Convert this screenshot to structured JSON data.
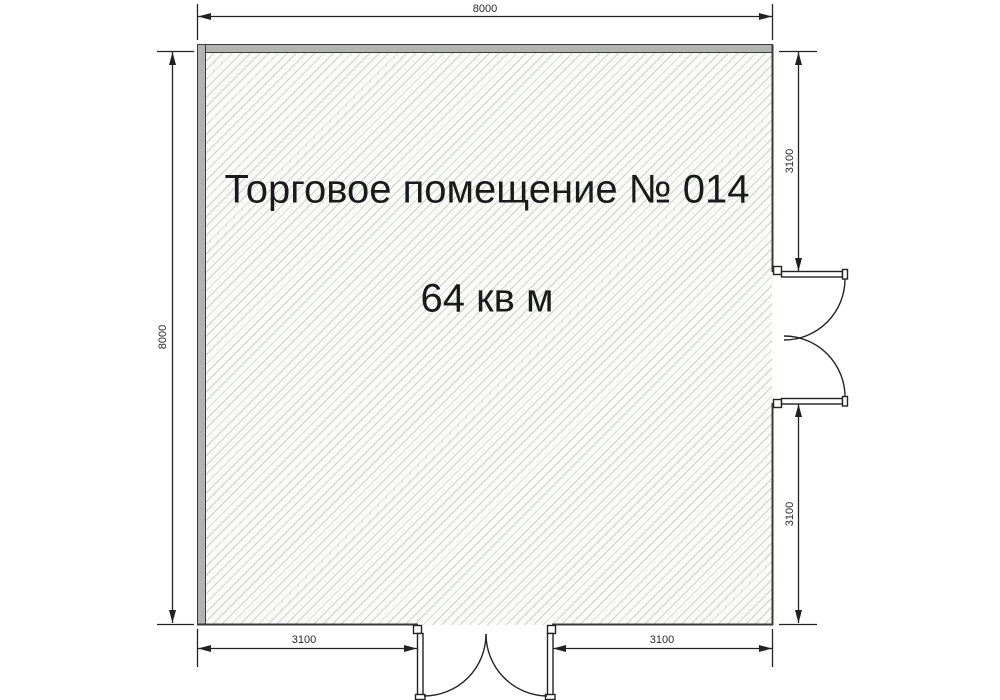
{
  "floor_plan": {
    "room_name": "Торговое помещение № 014",
    "room_area": "64 кв м",
    "dimensions": {
      "top_width": "8000",
      "left_height": "8000",
      "right_upper": "3100",
      "right_lower": "3100",
      "bottom_left": "3100",
      "bottom_right": "3100"
    },
    "doors": {
      "right_door": "double-swing-door",
      "bottom_door": "double-swing-door"
    },
    "colors": {
      "background": "#ffffff",
      "wall_fill": "#b3b3b3",
      "wall_stroke": "#3c3c3c",
      "hatch_line": "#c7d4c7",
      "hatch_background": "#fbfcfa",
      "line_color": "#222222",
      "text_color": "#1a1a1a"
    }
  }
}
